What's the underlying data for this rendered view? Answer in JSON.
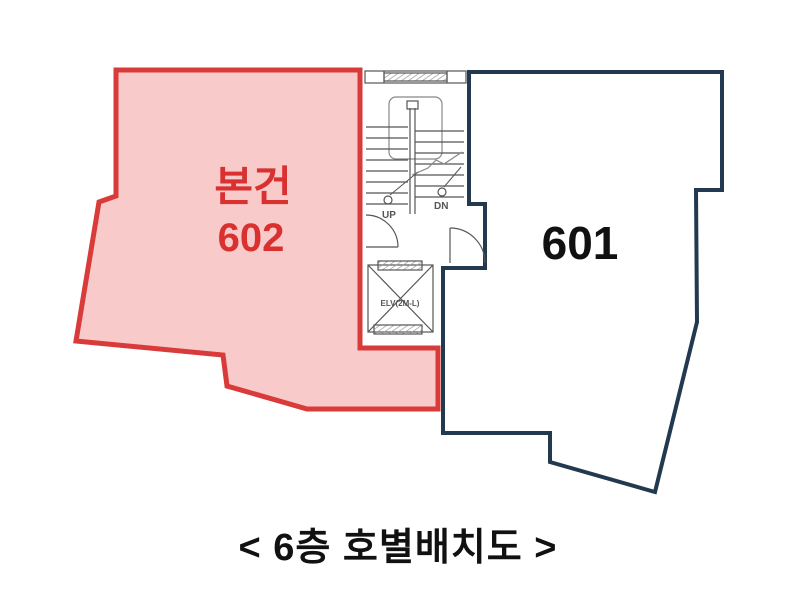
{
  "diagram": {
    "unit602": {
      "tag": "본건",
      "number": "602"
    },
    "unit601": {
      "number": "601"
    },
    "stairs": {
      "up_label": "UP",
      "dn_label": "DN"
    },
    "elevator": {
      "label": "ELV(2M-L)"
    },
    "caption": "< 6층 호별배치도 >"
  },
  "colors": {
    "unit602_border": "#d93a3a",
    "unit602_fill": "#f9caca",
    "unit602_text": "#d93030",
    "unit601_border": "#223950",
    "unit601_fill": "#ffffff",
    "unit601_text": "#111111",
    "plan_lines": "#555555",
    "plan_lines_light": "#888888",
    "caption_text": "#111111",
    "background": "#ffffff"
  }
}
